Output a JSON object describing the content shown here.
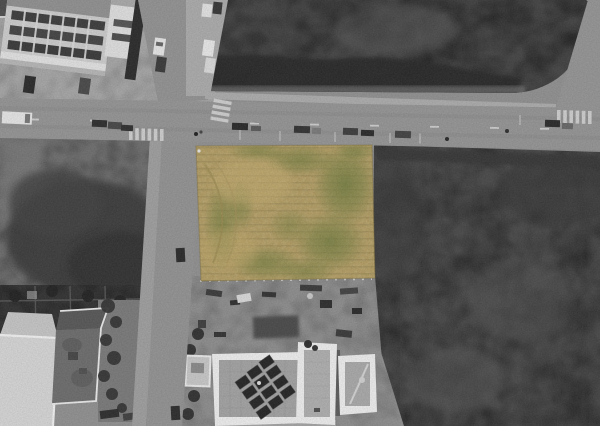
{
  "scene": {
    "kind": "aerial-drone-photo",
    "treatment": "grayscale-except-highlighted-parcel",
    "highlighted_parcel": {
      "surface": "mown-grass-field",
      "shape": "rectangular",
      "base_color": "#b29c62",
      "green_patch_color": "#6e7a3e",
      "light_patch_color": "#c3ac6f",
      "stripe_tint": "#605430"
    },
    "palette": {
      "ground_base": "#909090",
      "road": "#949494",
      "road_secondary": "#929292",
      "sidewalk": "#a6a6a6",
      "field_light": "#6e6e6e",
      "field_dark": "#454545",
      "field_right": "#4a4a4a",
      "vegetation_dark": "#2c2c2c",
      "hedge_dark": "#383838",
      "building_light": "#d4d4d4",
      "building_parapet": "#ececec",
      "roof_inner": "#a2a2a2",
      "roof_dark": "#4e4e4e",
      "garden_dark": "#333333",
      "gravel": "#8d8d8d",
      "car_dark": "#2e2e2e",
      "car_white": "#e4e4e4",
      "marking_white": "#d8d8d8",
      "solar_panel": "#262626"
    },
    "objects": {
      "parked_cars_on_main_road": 12,
      "solar_panel_modules": 12,
      "crosswalks": 3,
      "buildings_bottom": 3
    }
  }
}
